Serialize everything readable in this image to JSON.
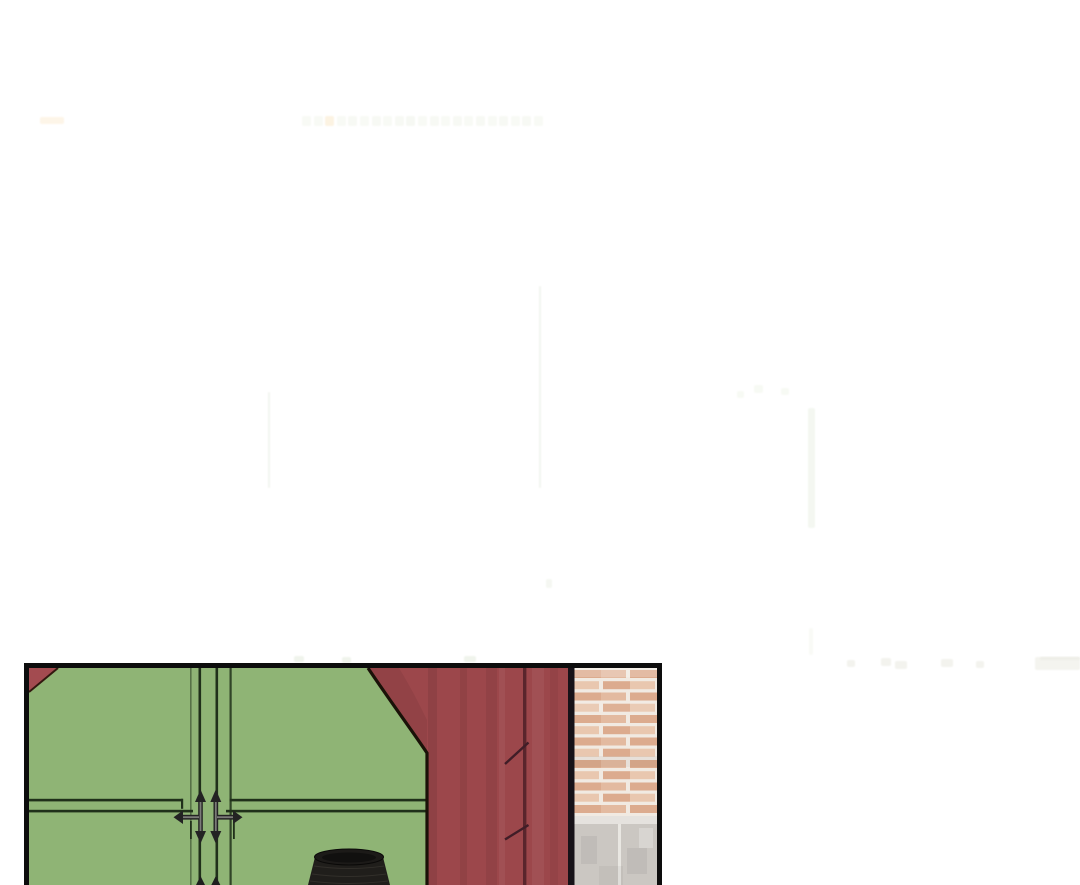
{
  "page": {
    "kind": "webtoon strip segment: large white gutter above a single comic panel",
    "background_color": "#ffffff",
    "width": 1080,
    "height": 885
  },
  "comic_panel": {
    "semantic": "panel of closed green double doors with decorative arrow-cross handles; dark red wooden pillar with a vertical seam; brick wall on a pale concrete footing; black woven basket in front of the doors (cut off by image bottom)",
    "objects": [
      "left-door",
      "right-door",
      "door-gap",
      "door-handle-left",
      "door-handle-right",
      "corner-red-triangle",
      "red-pillar",
      "pillar-seam",
      "brick-wall",
      "concrete-footing",
      "black-basket"
    ],
    "colors": {
      "page_bg": "#ffffff",
      "panel_border": "#0d0d0d",
      "door_green": "#8fb475",
      "trim_dark": "#20301a",
      "corner_red": "#a34b50",
      "wall_red": "#9c474b",
      "seam_red": "#5a252c",
      "edge_black": "#171218",
      "brick": "#dcab8e",
      "brick_light": "#e9c7af",
      "mortar": "#f1eae2",
      "concrete": "#cbc7c2",
      "concrete_light": "#e5e2de",
      "basket": "#201e1b",
      "handle_metal": "#7b7b78"
    }
  },
  "ghost_artifacts": {
    "note": "extremely faint near-white compression remnants (illegible ghost text row and stray strokes) on the white gutter",
    "rects": [
      {
        "x": 40,
        "y": 117,
        "w": 24,
        "h": 7,
        "c": "#fdf5e8"
      },
      {
        "x": 302,
        "y": 116,
        "w": 9,
        "h": 10,
        "c": "#f8faf5"
      },
      {
        "x": 314,
        "y": 116,
        "w": 9,
        "h": 10,
        "c": "#f8faf5"
      },
      {
        "x": 325,
        "y": 116,
        "w": 9,
        "h": 10,
        "c": "#fcf3e2"
      },
      {
        "x": 337,
        "y": 116,
        "w": 9,
        "h": 10,
        "c": "#f8faf5"
      },
      {
        "x": 348,
        "y": 116,
        "w": 9,
        "h": 10,
        "c": "#f7f9f4"
      },
      {
        "x": 360,
        "y": 116,
        "w": 9,
        "h": 10,
        "c": "#f8faf5"
      },
      {
        "x": 372,
        "y": 116,
        "w": 9,
        "h": 10,
        "c": "#f7f9f4"
      },
      {
        "x": 383,
        "y": 116,
        "w": 9,
        "h": 10,
        "c": "#f8faf5"
      },
      {
        "x": 395,
        "y": 116,
        "w": 9,
        "h": 10,
        "c": "#f7f9f4"
      },
      {
        "x": 406,
        "y": 116,
        "w": 9,
        "h": 10,
        "c": "#f6f8f3"
      },
      {
        "x": 418,
        "y": 116,
        "w": 9,
        "h": 10,
        "c": "#f8faf5"
      },
      {
        "x": 430,
        "y": 116,
        "w": 9,
        "h": 10,
        "c": "#f7f9f4"
      },
      {
        "x": 441,
        "y": 116,
        "w": 9,
        "h": 10,
        "c": "#f8faf5"
      },
      {
        "x": 453,
        "y": 116,
        "w": 9,
        "h": 10,
        "c": "#f7f9f4"
      },
      {
        "x": 464,
        "y": 116,
        "w": 9,
        "h": 10,
        "c": "#f8faf5"
      },
      {
        "x": 476,
        "y": 116,
        "w": 9,
        "h": 10,
        "c": "#f7f9f4"
      },
      {
        "x": 488,
        "y": 116,
        "w": 9,
        "h": 10,
        "c": "#f8faf5"
      },
      {
        "x": 499,
        "y": 116,
        "w": 9,
        "h": 10,
        "c": "#f7f9f4"
      },
      {
        "x": 511,
        "y": 116,
        "w": 9,
        "h": 10,
        "c": "#f8faf5"
      },
      {
        "x": 522,
        "y": 116,
        "w": 9,
        "h": 10,
        "c": "#f7f9f4"
      },
      {
        "x": 534,
        "y": 116,
        "w": 9,
        "h": 10,
        "c": "#f8faf5"
      },
      {
        "x": 268,
        "y": 392,
        "w": 2,
        "h": 96,
        "c": "#f2f5ef"
      },
      {
        "x": 539,
        "y": 286,
        "w": 2,
        "h": 202,
        "c": "#f2f5ef"
      },
      {
        "x": 737,
        "y": 391,
        "w": 7,
        "h": 7,
        "c": "#f7faf4"
      },
      {
        "x": 754,
        "y": 385,
        "w": 9,
        "h": 8,
        "c": "#f7faf4"
      },
      {
        "x": 781,
        "y": 388,
        "w": 8,
        "h": 7,
        "c": "#f7faf4"
      },
      {
        "x": 808,
        "y": 408,
        "w": 7,
        "h": 120,
        "c": "#f4f7f1"
      },
      {
        "x": 809,
        "y": 628,
        "w": 4,
        "h": 27,
        "c": "#f9faf6"
      },
      {
        "x": 546,
        "y": 579,
        "w": 6,
        "h": 9,
        "c": "#f5f7f2"
      },
      {
        "x": 294,
        "y": 656,
        "w": 10,
        "h": 6,
        "c": "#f0f4ec"
      },
      {
        "x": 342,
        "y": 657,
        "w": 9,
        "h": 6,
        "c": "#f0f4ec"
      },
      {
        "x": 464,
        "y": 656,
        "w": 12,
        "h": 6,
        "c": "#f0f4ec"
      },
      {
        "x": 847,
        "y": 660,
        "w": 8,
        "h": 7,
        "c": "#f3f3ee"
      },
      {
        "x": 881,
        "y": 658,
        "w": 10,
        "h": 8,
        "c": "#f3f3ee"
      },
      {
        "x": 895,
        "y": 661,
        "w": 12,
        "h": 8,
        "c": "#f3f3ee"
      },
      {
        "x": 941,
        "y": 659,
        "w": 12,
        "h": 8,
        "c": "#f3f3ee"
      },
      {
        "x": 976,
        "y": 661,
        "w": 8,
        "h": 7,
        "c": "#f3f3ee"
      },
      {
        "x": 1035,
        "y": 657,
        "w": 45,
        "h": 13,
        "c": "#f4f4ef"
      },
      {
        "x": 1040,
        "y": 657,
        "w": 40,
        "h": 3,
        "c": "#eeeee8"
      }
    ]
  }
}
